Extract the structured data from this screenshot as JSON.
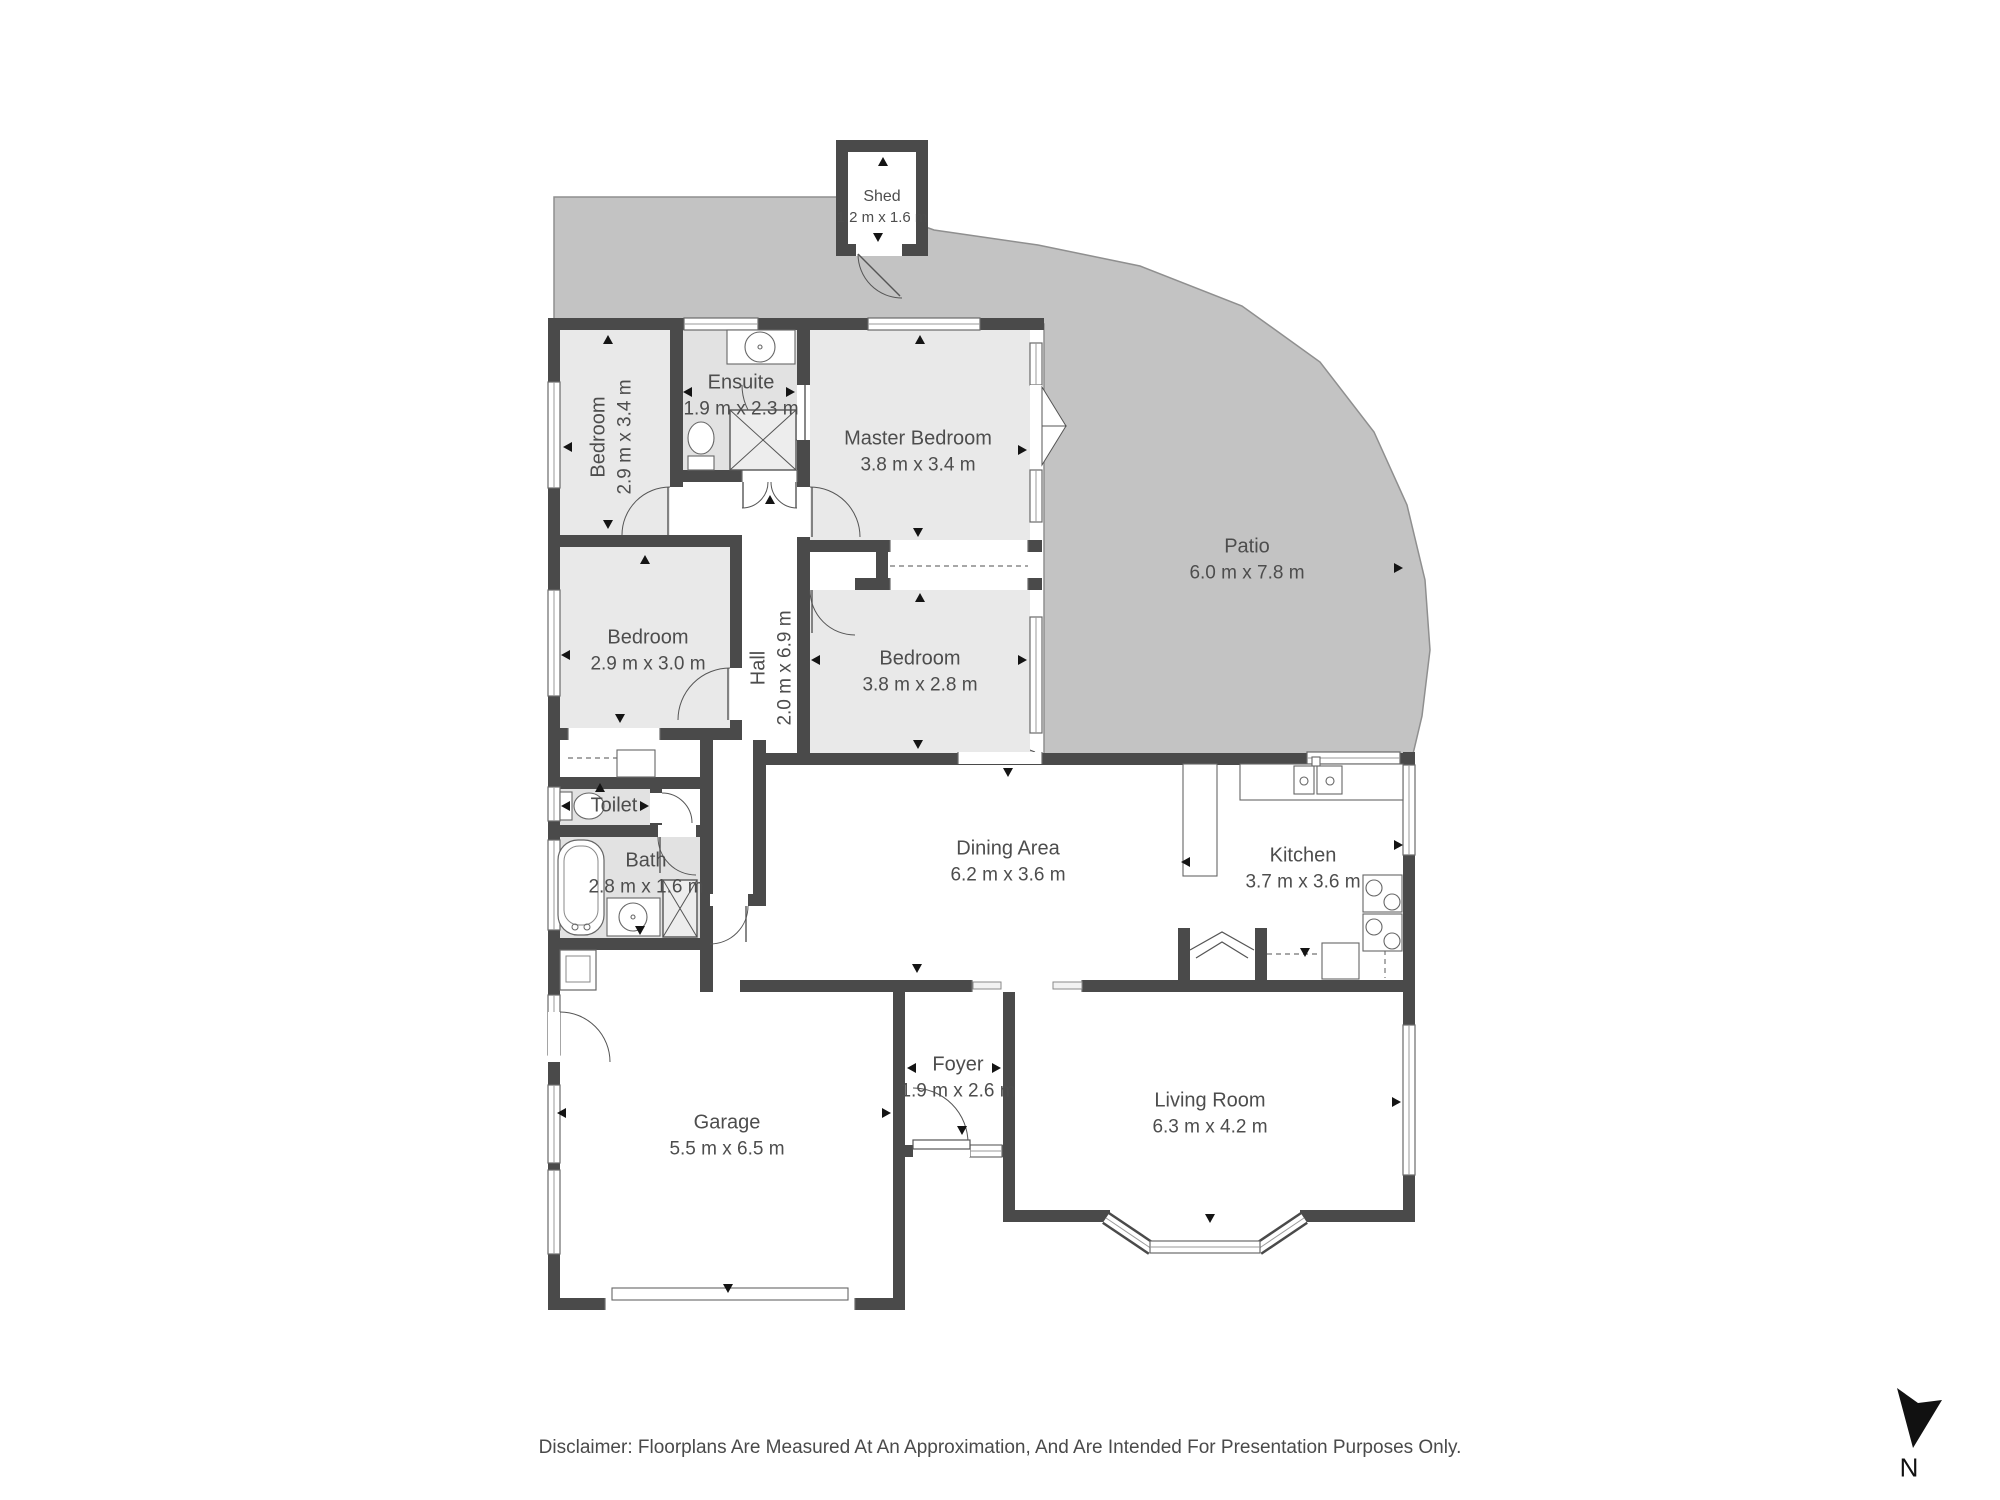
{
  "page": {
    "title": "Floorplan",
    "background": "#ffffff",
    "disclaimer": "Disclaimer: Floorplans Are Measured At An Approximation, And Are Intended For Presentation Purposes Only."
  },
  "colors": {
    "wall": "#4a4a4a",
    "room_gray": "#e9e9e9",
    "wet_gray": "#e2e2e2",
    "white": "#ffffff",
    "patio": "#c3c3c3",
    "patio_edge": "#8f8f8f",
    "fixture_line": "#555555",
    "thin_line": "#9a9a9a",
    "label": "#4d4d4d",
    "marker": "#141414"
  },
  "north": {
    "label": "N",
    "polygon": "1897,1388 1918,1403 1942,1400 1913,1448",
    "label_x": 1909,
    "label_y": 1468
  },
  "rooms": [
    {
      "id": "shed",
      "name": "Shed",
      "dims": "1.2 m x 1.6 m",
      "label": {
        "x": 882,
        "y": 207,
        "rotate": false,
        "small": true
      }
    },
    {
      "id": "bedroom-1",
      "name": "Bedroom",
      "dims": "2.9 m x 3.4 m",
      "label": {
        "x": 612,
        "y": 437,
        "rotate": true,
        "small": false
      }
    },
    {
      "id": "ensuite",
      "name": "Ensuite",
      "dims": "1.9 m x 2.3 m",
      "label": {
        "x": 741,
        "y": 396,
        "rotate": false,
        "small": false
      }
    },
    {
      "id": "master-bedroom",
      "name": "Master Bedroom",
      "dims": "3.8 m x 3.4 m",
      "label": {
        "x": 918,
        "y": 452,
        "rotate": false,
        "small": false
      }
    },
    {
      "id": "patio",
      "name": "Patio",
      "dims": "6.0 m x 7.8 m",
      "label": {
        "x": 1247,
        "y": 560,
        "rotate": false,
        "small": false
      }
    },
    {
      "id": "bedroom-2",
      "name": "Bedroom",
      "dims": "2.9 m x 3.0 m",
      "label": {
        "x": 648,
        "y": 651,
        "rotate": false,
        "small": false
      }
    },
    {
      "id": "hall",
      "name": "Hall",
      "dims": "2.0 m x 6.9 m",
      "label": {
        "x": 772,
        "y": 668,
        "rotate": true,
        "small": false
      }
    },
    {
      "id": "bedroom-3",
      "name": "Bedroom",
      "dims": "3.8 m x 2.8 m",
      "label": {
        "x": 920,
        "y": 672,
        "rotate": false,
        "small": false
      }
    },
    {
      "id": "toilet",
      "name": "Toilet",
      "dims": "",
      "label": {
        "x": 614,
        "y": 806,
        "rotate": false,
        "small": false
      }
    },
    {
      "id": "bath",
      "name": "Bath",
      "dims": "2.8 m x 1.6 m",
      "label": {
        "x": 646,
        "y": 874,
        "rotate": false,
        "small": false
      }
    },
    {
      "id": "dining-area",
      "name": "Dining Area",
      "dims": "6.2 m x 3.6 m",
      "label": {
        "x": 1008,
        "y": 862,
        "rotate": false,
        "small": false
      }
    },
    {
      "id": "kitchen",
      "name": "Kitchen",
      "dims": "3.7 m x 3.6 m",
      "label": {
        "x": 1303,
        "y": 869,
        "rotate": false,
        "small": false
      }
    },
    {
      "id": "garage",
      "name": "Garage",
      "dims": "5.5 m x 6.5 m",
      "label": {
        "x": 727,
        "y": 1136,
        "rotate": false,
        "small": false
      }
    },
    {
      "id": "foyer",
      "name": "Foyer",
      "dims": "1.9 m x 2.6 m",
      "label": {
        "x": 958,
        "y": 1078,
        "rotate": false,
        "small": false
      }
    },
    {
      "id": "living-room",
      "name": "Living Room",
      "dims": "6.3 m x 4.2 m",
      "label": {
        "x": 1210,
        "y": 1114,
        "rotate": false,
        "small": false
      }
    }
  ],
  "geometry": {
    "patio_polygon": "554,197 842,197 934,230 1038,245 1140,266 1242,306 1320,362 1374,432 1407,505 1425,580 1430,650 1422,716 1413,754 1044,754 1044,324 554,324",
    "patio_steps": [
      "963,752 999,738 1035,752",
      "975,752 999,744 1023,752"
    ],
    "shed": {
      "outer": [
        836,
        140,
        92,
        116
      ],
      "inner": [
        848,
        152,
        68,
        92
      ]
    },
    "room_fills": [
      {
        "rect": [
          560,
          330,
          110,
          205
        ],
        "fill": "room_gray"
      },
      {
        "rect": [
          683,
          330,
          114,
          140
        ],
        "fill": "wet_gray"
      },
      {
        "rect": [
          810,
          330,
          220,
          210
        ],
        "fill": "room_gray"
      },
      {
        "rect": [
          560,
          547,
          170,
          181
        ],
        "fill": "room_gray"
      },
      {
        "rect": [
          810,
          590,
          220,
          163
        ],
        "fill": "room_gray"
      },
      {
        "rect": [
          560,
          789,
          90,
          36
        ],
        "fill": "wet_gray"
      },
      {
        "rect": [
          560,
          837,
          141,
          101
        ],
        "fill": "wet_gray"
      },
      {
        "rect": [
          742,
          482,
          55,
          278
        ],
        "fill": "white"
      },
      {
        "rect": [
          713,
          737,
          40,
          157
        ],
        "fill": "white"
      },
      {
        "rect": [
          810,
          552,
          220,
          26
        ],
        "fill": "white"
      },
      {
        "rect": [
          560,
          740,
          140,
          37
        ],
        "fill": "white"
      },
      {
        "rect": [
          662,
          789,
          39,
          36
        ],
        "fill": "white"
      },
      {
        "rect": [
          766,
          765,
          637,
          215
        ],
        "fill": "white"
      },
      {
        "rect": [
          713,
          906,
          53,
          74
        ],
        "fill": "white"
      },
      {
        "rect": [
          905,
          992,
          98,
          153
        ],
        "fill": "white"
      },
      {
        "rect": [
          1015,
          992,
          388,
          218
        ],
        "fill": "white"
      },
      {
        "rect": [
          560,
          950,
          333,
          348
        ],
        "fill": "white"
      }
    ],
    "walls": [
      [
        548,
        318,
        496,
        12
      ],
      [
        548,
        318,
        12,
        992
      ],
      [
        548,
        1298,
        357,
        12
      ],
      [
        893,
        980,
        12,
        330
      ],
      [
        893,
        1145,
        122,
        12
      ],
      [
        1003,
        992,
        12,
        230
      ],
      [
        1015,
        1210,
        95,
        12
      ],
      [
        1300,
        1210,
        115,
        12
      ],
      [
        1403,
        752,
        12,
        470
      ],
      [
        766,
        753,
        649,
        12
      ],
      [
        740,
        980,
        232,
        12
      ],
      [
        1082,
        980,
        333,
        12
      ],
      [
        670,
        318,
        13,
        217
      ],
      [
        548,
        535,
        194,
        12
      ],
      [
        730,
        535,
        12,
        205
      ],
      [
        683,
        470,
        127,
        12
      ],
      [
        797,
        330,
        13,
        423
      ],
      [
        797,
        540,
        245,
        12
      ],
      [
        797,
        578,
        245,
        12
      ],
      [
        876,
        552,
        12,
        26
      ],
      [
        548,
        728,
        194,
        12
      ],
      [
        548,
        777,
        164,
        12
      ],
      [
        548,
        825,
        164,
        12
      ],
      [
        548,
        938,
        165,
        12
      ],
      [
        700,
        737,
        13,
        255
      ],
      [
        753,
        740,
        13,
        166
      ],
      [
        700,
        894,
        66,
        12
      ],
      [
        650,
        789,
        12,
        36
      ]
    ],
    "windows": [
      [
        684,
        318,
        74,
        12
      ],
      [
        868,
        318,
        112,
        12
      ],
      [
        1030,
        343,
        12,
        42
      ],
      [
        1030,
        470,
        12,
        52
      ],
      [
        1030,
        617,
        12,
        116
      ],
      [
        548,
        382,
        12,
        106
      ],
      [
        548,
        590,
        12,
        106
      ],
      [
        548,
        787,
        12,
        34
      ],
      [
        548,
        840,
        12,
        90
      ],
      [
        548,
        995,
        12,
        60
      ],
      [
        548,
        1085,
        12,
        78
      ],
      [
        548,
        1170,
        12,
        84
      ],
      [
        1403,
        765,
        12,
        90
      ],
      [
        1403,
        1025,
        12,
        150
      ],
      [
        1307,
        752,
        93,
        12
      ],
      [
        1150,
        1241,
        110,
        12
      ],
      [
        970,
        1145,
        32,
        12
      ]
    ],
    "openings": [
      [
        958,
        752,
        84,
        12
      ],
      [
        890,
        540,
        138,
        12
      ],
      [
        890,
        578,
        138,
        12
      ],
      [
        568,
        728,
        92,
        12
      ],
      [
        742,
        470,
        55,
        12
      ],
      [
        605,
        1298,
        250,
        12
      ],
      [
        972,
        980,
        110,
        12
      ]
    ],
    "jamb_bars": [
      [
        973,
        982,
        28,
        7
      ],
      [
        1053,
        982,
        29,
        7
      ]
    ],
    "dashed_lines": [
      [
        568,
        758,
        652,
        758
      ],
      [
        890,
        566,
        1028,
        566
      ],
      [
        1267,
        954,
        1320,
        954
      ],
      [
        1385,
        932,
        1385,
        978
      ]
    ],
    "doors": [
      {
        "gap": [
          856,
          244,
          46,
          12
        ],
        "arc": "M 858 254 A 44 44 0 0 0 902 298",
        "line": [
          858,
          254,
          900,
          296
        ]
      },
      {
        "gap": [
          670,
          487,
          13,
          48
        ],
        "arc": "M 670 487 A 48 48 0 0 0 622 535",
        "line": [
          668,
          487,
          668,
          535
        ]
      },
      {
        "gap": [
          730,
          668,
          12,
          52
        ],
        "arc": "M 730 668 A 52 52 0 0 0 678 720",
        "line": [
          728,
          668,
          728,
          720
        ]
      },
      {
        "gap": [
          810,
          578,
          45,
          12
        ],
        "arc": "M 810 590 A 45 45 0 0 0 855 635",
        "line": [
          812,
          590,
          812,
          633
        ]
      },
      {
        "gap": [
          797,
          487,
          13,
          50
        ],
        "arc": "M 810 487 A 50 50 0 0 1 860 537",
        "line": [
          812,
          487,
          812,
          537
        ]
      },
      {
        "gap": [
          797,
          385,
          13,
          55
        ],
        "arc": "M 797 440 A 55 55 0 0 1 742 385",
        "line": [
          805,
          385,
          805,
          440
        ]
      },
      {
        "gap": null,
        "arc": "M 768 482 A 26 26 0 0 1 742 508",
        "line": [
          743,
          482,
          743,
          508
        ]
      },
      {
        "gap": null,
        "arc": "M 771 482 A 26 26 0 0 0 797 508",
        "line": [
          796,
          482,
          796,
          508
        ]
      },
      {
        "gap": [
          658,
          825,
          38,
          12
        ],
        "arc": "M 658 837 A 38 38 0 0 0 696 875",
        "line": [
          660,
          837,
          660,
          873
        ]
      },
      {
        "gap": [
          650,
          793,
          12,
          30
        ],
        "arc": "M 662 793 A 30 30 0 0 1 692 823",
        "line": null
      },
      {
        "gap": [
          710,
          894,
          38,
          12
        ],
        "arc": "M 748 906 A 38 38 0 0 1 710 944",
        "line": [
          746,
          906,
          746,
          942
        ]
      },
      {
        "gap": [
          913,
          1145,
          57,
          12
        ],
        "arc": "M 968 1143 A 55 55 0 0 0 913 1088",
        "line": null
      },
      {
        "gap": [
          548,
          1012,
          12,
          50
        ],
        "arc": "M 560 1012 A 50 50 0 0 1 610 1062",
        "line": null
      }
    ],
    "front_door_leaf": [
      913,
      1140,
      57,
      9
    ],
    "patio_door": {
      "gap": [
        1030,
        385,
        12,
        82
      ],
      "wedges": [
        "1042,387 1066,426 1042,426",
        "1042,465 1066,426 1042,426"
      ]
    },
    "bay_diagonals": [
      [
        1106,
        1218,
        1152,
        1249
      ],
      [
        1258,
        1249,
        1304,
        1218
      ]
    ],
    "fireplace": {
      "walls": [
        [
          1178,
          928,
          12,
          64
        ],
        [
          1255,
          928,
          12,
          64
        ],
        [
          1178,
          980,
          89,
          12
        ]
      ],
      "inner": [
        1190,
        928,
        65,
        52
      ],
      "chevrons": [
        "1190,950 1222,932 1254,950",
        "1196,958 1222,942 1248,958"
      ]
    },
    "fixtures": {
      "rects": [
        [
          727,
          330,
          68,
          34
        ],
        [
          607,
          898,
          53,
          38
        ],
        [
          1240,
          764,
          163,
          36
        ],
        [
          1183,
          764,
          34,
          112
        ],
        [
          1294,
          766,
          20,
          28
        ],
        [
          1317,
          766,
          25,
          28
        ],
        [
          1363,
          875,
          39,
          37
        ],
        [
          1363,
          914,
          39,
          37
        ],
        [
          1322,
          943,
          37,
          36
        ],
        [
          617,
          750,
          38,
          27
        ],
        [
          612,
          1288,
          236,
          12
        ],
        [
          688,
          456,
          26,
          14
        ],
        [
          560,
          792,
          12,
          28
        ],
        [
          1312,
          757,
          8,
          9
        ]
      ],
      "circles": [
        [
          760,
          347,
          15
        ],
        [
          633,
          917,
          14
        ],
        [
          1304,
          781,
          4
        ],
        [
          1330,
          781,
          4
        ],
        [
          1374,
          888,
          8
        ],
        [
          1392,
          902,
          8
        ],
        [
          1374,
          927,
          8
        ],
        [
          1392,
          941,
          8
        ],
        [
          760,
          347,
          2
        ],
        [
          633,
          917,
          2
        ],
        [
          577,
          974,
          4
        ]
      ],
      "ellipses": [
        [
          701,
          438,
          13,
          16
        ],
        [
          589,
          806,
          15,
          13
        ]
      ],
      "xboxes": [
        [
          730,
          410,
          66,
          60
        ],
        [
          663,
          880,
          34,
          57
        ]
      ],
      "tub": [
        558,
        840,
        46,
        95
      ],
      "garage_sink": {
        "outer": [
          560,
          950,
          36,
          40
        ],
        "inner": [
          566,
          956,
          24,
          26
        ]
      }
    },
    "markers": [
      [
        883,
        162,
        "up"
      ],
      [
        878,
        237,
        "down"
      ],
      [
        608,
        340,
        "up"
      ],
      [
        920,
        340,
        "up"
      ],
      [
        568,
        447,
        "left"
      ],
      [
        608,
        524,
        "down"
      ],
      [
        688,
        392,
        "left"
      ],
      [
        790,
        392,
        "right"
      ],
      [
        1022,
        450,
        "right"
      ],
      [
        918,
        532,
        "down"
      ],
      [
        645,
        560,
        "up"
      ],
      [
        566,
        655,
        "left"
      ],
      [
        620,
        718,
        "down"
      ],
      [
        770,
        500,
        "up"
      ],
      [
        920,
        598,
        "up"
      ],
      [
        816,
        660,
        "left"
      ],
      [
        1022,
        660,
        "right"
      ],
      [
        918,
        744,
        "down"
      ],
      [
        1398,
        568,
        "right"
      ],
      [
        600,
        788,
        "up"
      ],
      [
        566,
        806,
        "left"
      ],
      [
        644,
        806,
        "right"
      ],
      [
        640,
        930,
        "down"
      ],
      [
        1008,
        772,
        "down"
      ],
      [
        917,
        968,
        "down"
      ],
      [
        1186,
        862,
        "left"
      ],
      [
        1398,
        845,
        "right"
      ],
      [
        1305,
        952,
        "down"
      ],
      [
        728,
        1288,
        "down"
      ],
      [
        562,
        1113,
        "left"
      ],
      [
        886,
        1113,
        "right"
      ],
      [
        912,
        1068,
        "left"
      ],
      [
        996,
        1068,
        "right"
      ],
      [
        962,
        1130,
        "down"
      ],
      [
        1396,
        1102,
        "right"
      ],
      [
        1210,
        1218,
        "down"
      ]
    ]
  }
}
